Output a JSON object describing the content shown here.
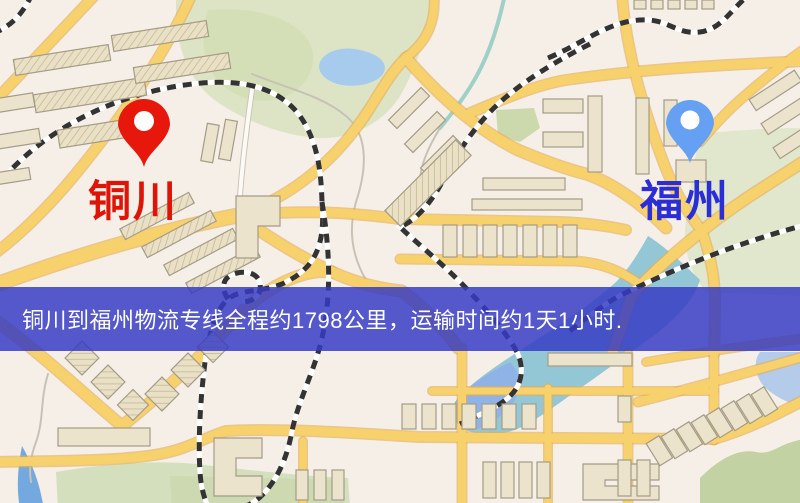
{
  "map": {
    "origin": {
      "name": "铜川",
      "pin_color": "#e8170c",
      "label_color": "#df1408"
    },
    "destination": {
      "name": "福州",
      "pin_color": "#66a0f2",
      "label_color": "#2b2ed6"
    },
    "banner": {
      "text": "铜川到福州物流专线全程约1798公里，运输时间约1天1小时.",
      "bg_color": "#343ac4",
      "text_color": "#ffffff"
    },
    "route": {
      "distance_km": "1798",
      "duration": "1天1小时"
    }
  }
}
